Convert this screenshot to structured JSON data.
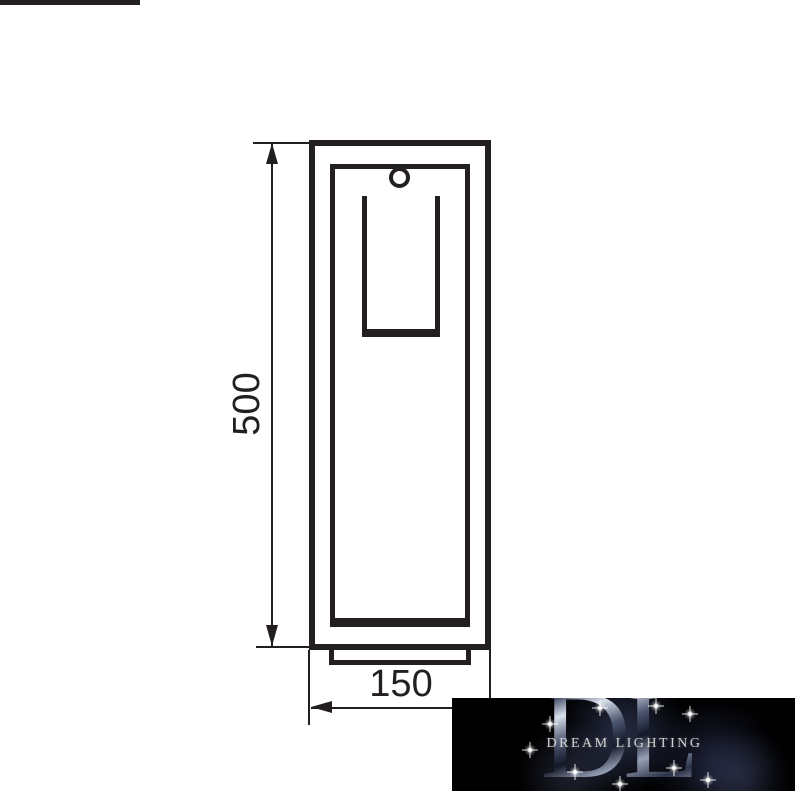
{
  "diagram": {
    "line_color": "#231f20",
    "background_color": "#ffffff",
    "dimensions": {
      "height_label": "500",
      "width_label": "150"
    }
  },
  "logo": {
    "monogram_d": "D",
    "monogram_l": "L",
    "name": "DREAM LIGHTING",
    "background_color": "#000000",
    "text_color": "#d2d2d2",
    "sparkle_color": "#ffffff"
  }
}
